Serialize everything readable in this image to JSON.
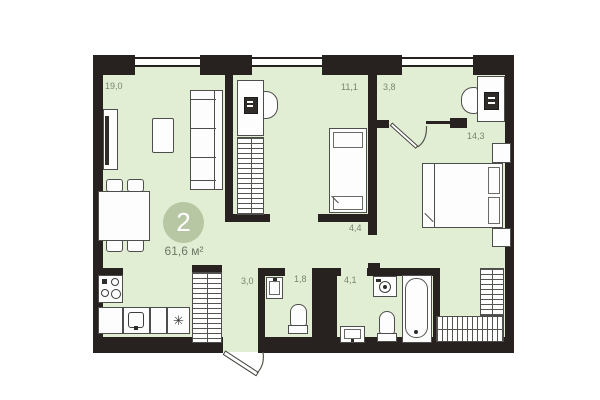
{
  "plan": {
    "unit_number": "2",
    "total_area": "61,6 м²"
  },
  "rooms": {
    "living": {
      "area": "19,0"
    },
    "child_bedroom": {
      "area": "11,1"
    },
    "closet": {
      "area": "3,8"
    },
    "bedroom": {
      "area": "14,3"
    },
    "corridor": {
      "area": "4,4"
    },
    "hallway": {
      "area": "3,0"
    },
    "wc": {
      "area": "1,8"
    },
    "bathroom": {
      "area": "4,1"
    }
  },
  "icons": {
    "fridge": "✳"
  },
  "colors": {
    "wall": "#272220",
    "floor": "#e2eed4",
    "badge": "#b7c7a3",
    "label": "#7b8471",
    "furniture_outline": "#4d4d4b"
  }
}
